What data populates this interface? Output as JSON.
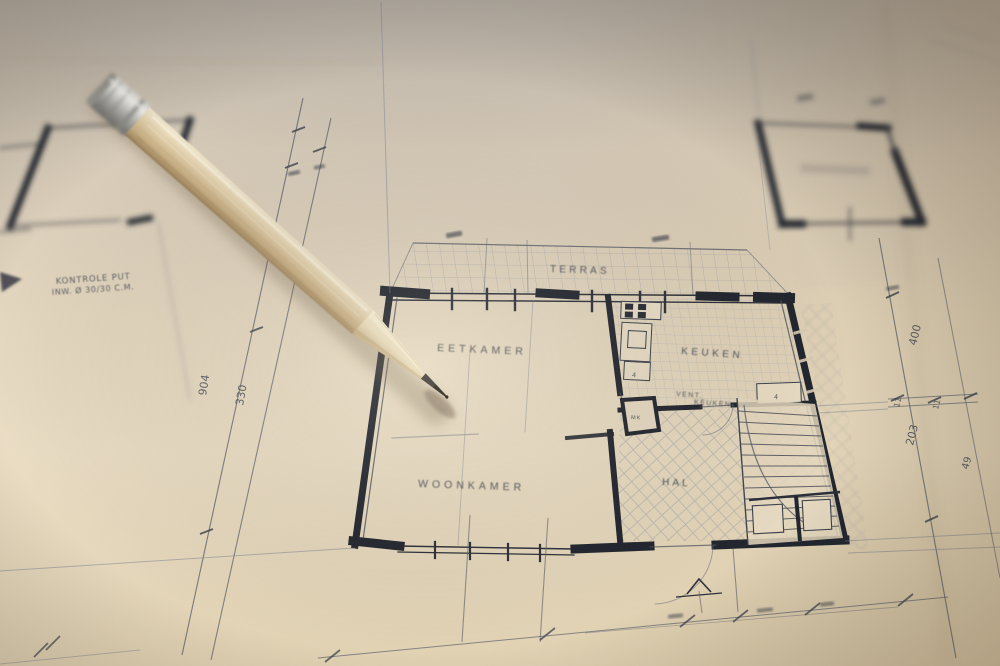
{
  "labels": {
    "terras": "TERRAS",
    "eetkamer": "EETKAMER",
    "keuken": "KEUKEN",
    "woonkamer": "WOONKAMER",
    "hal": "HAL",
    "vent_line1": "VENT.",
    "vent_line2": "KEUKEN",
    "mk": "MK",
    "fixture_mark": "4"
  },
  "annotations": {
    "kontrole_line1": "KONTROLE PUT",
    "kontrole_line2": "INW. Ø 30/30 C.M."
  },
  "dimensions": {
    "dim_904": "904",
    "dim_330": "330",
    "dim_400": "400",
    "dim_11_left": "11",
    "dim_11_right": "11",
    "dim_203": "203",
    "dim_49": "49"
  },
  "colors": {
    "paper_light": "#eee3cb",
    "paper_mid": "#e4d6bc",
    "paper_dark": "#c8bfb3",
    "ink_dark": "#20242d",
    "ink_faint": "#7b8090",
    "pencil_wood": "#dcc9a4",
    "pencil_ferrule": "#b7b6b2",
    "graphite": "#37332d"
  }
}
